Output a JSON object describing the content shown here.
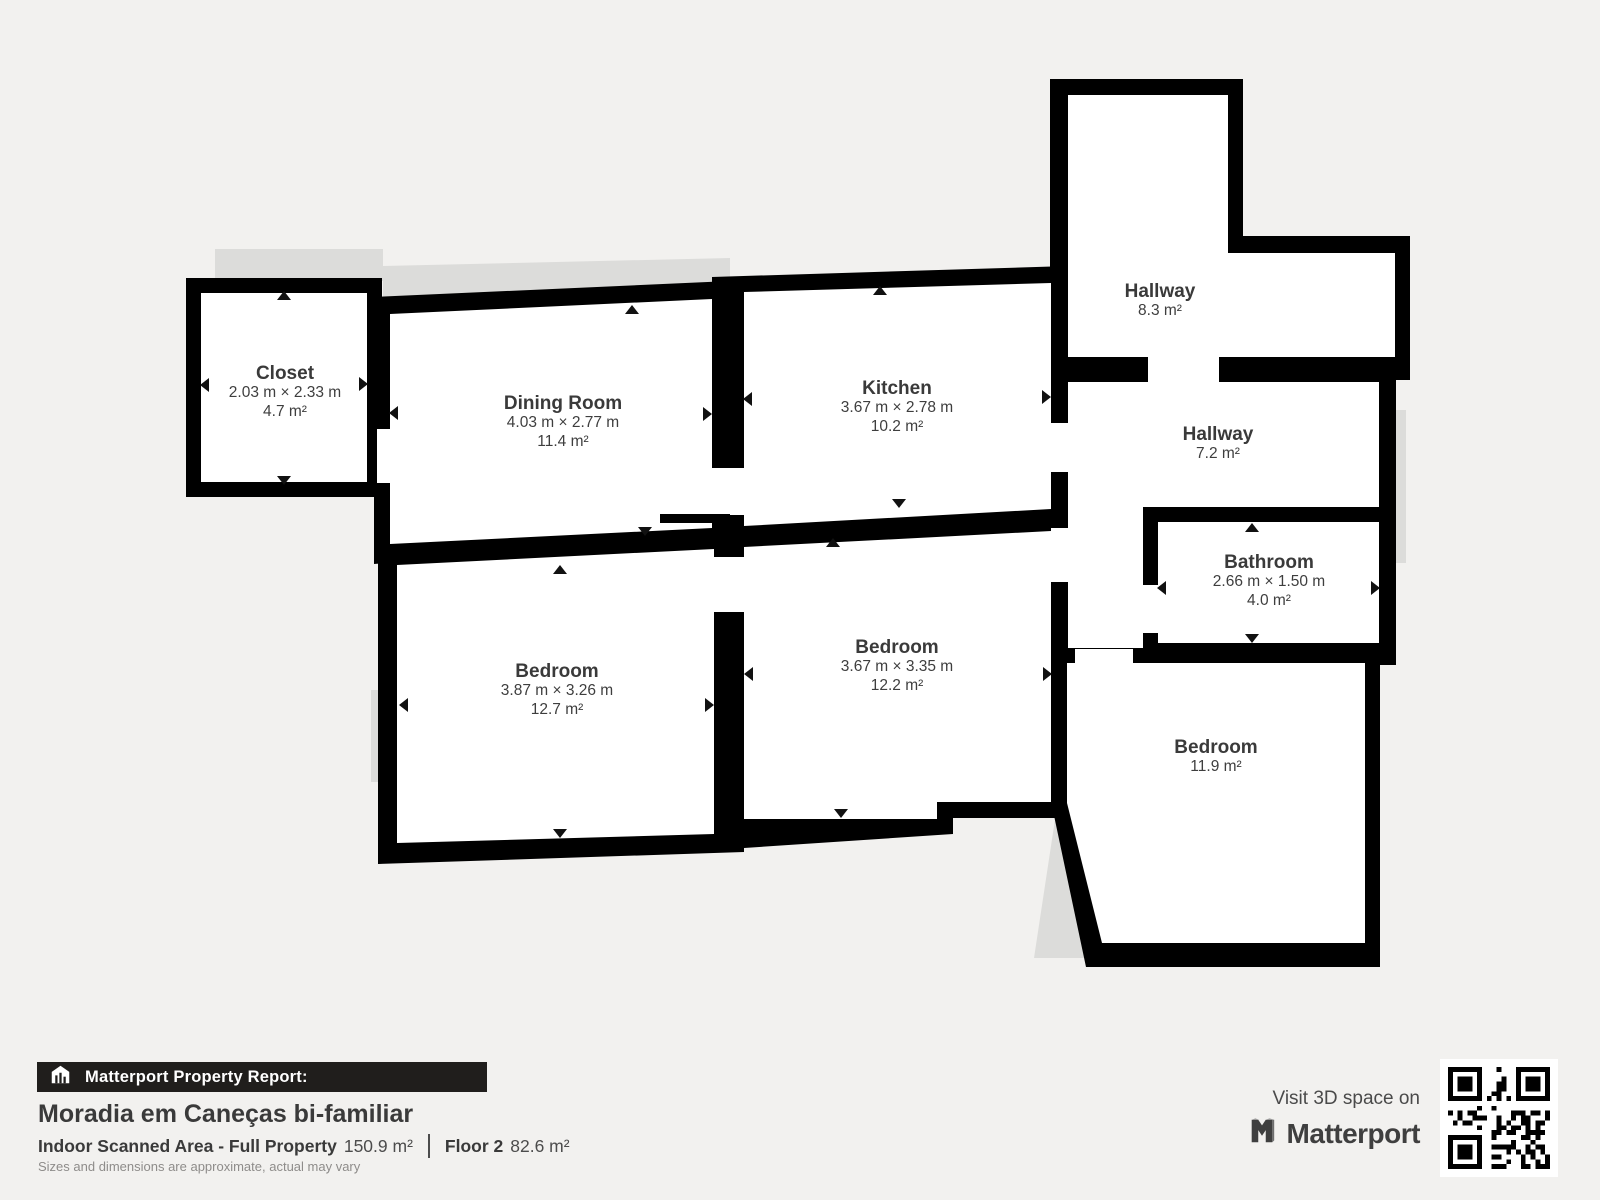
{
  "page": {
    "background": "#f2f1ef",
    "wall_color": "#000000",
    "room_fill": "#ffffff",
    "shadow_color": "#dcdcda"
  },
  "rooms": [
    {
      "id": "closet",
      "name": "Closet",
      "dimensions": "2.03 m × 2.33 m",
      "area": "4.7 m²"
    },
    {
      "id": "dining-room",
      "name": "Dining Room",
      "dimensions": "4.03 m × 2.77 m",
      "area": "11.4 m²"
    },
    {
      "id": "kitchen",
      "name": "Kitchen",
      "dimensions": "3.67 m × 2.78 m",
      "area": "10.2 m²"
    },
    {
      "id": "hallway-upper",
      "name": "Hallway",
      "area": "8.3 m²"
    },
    {
      "id": "hallway-lower",
      "name": "Hallway",
      "area": "7.2 m²"
    },
    {
      "id": "bathroom",
      "name": "Bathroom",
      "dimensions": "2.66 m × 1.50 m",
      "area": "4.0 m²"
    },
    {
      "id": "bedroom-left",
      "name": "Bedroom",
      "dimensions": "3.87 m × 3.26 m",
      "area": "12.7 m²"
    },
    {
      "id": "bedroom-middle",
      "name": "Bedroom",
      "dimensions": "3.67 m × 3.35 m",
      "area": "12.2 m²"
    },
    {
      "id": "bedroom-right",
      "name": "Bedroom",
      "area": "11.9 m²"
    }
  ],
  "footer": {
    "report_label": "Matterport Property Report:",
    "property_title": "Moradia em Caneças bi-familiar",
    "scanned_area_label": "Indoor Scanned Area - Full Property",
    "scanned_area_value": "150.9 m²",
    "floor_label": "Floor 2",
    "floor_value": "82.6 m²",
    "disclaimer": "Sizes and dimensions are approximate, actual may vary",
    "visit_label": "Visit 3D space on",
    "brand": "Matterport"
  }
}
